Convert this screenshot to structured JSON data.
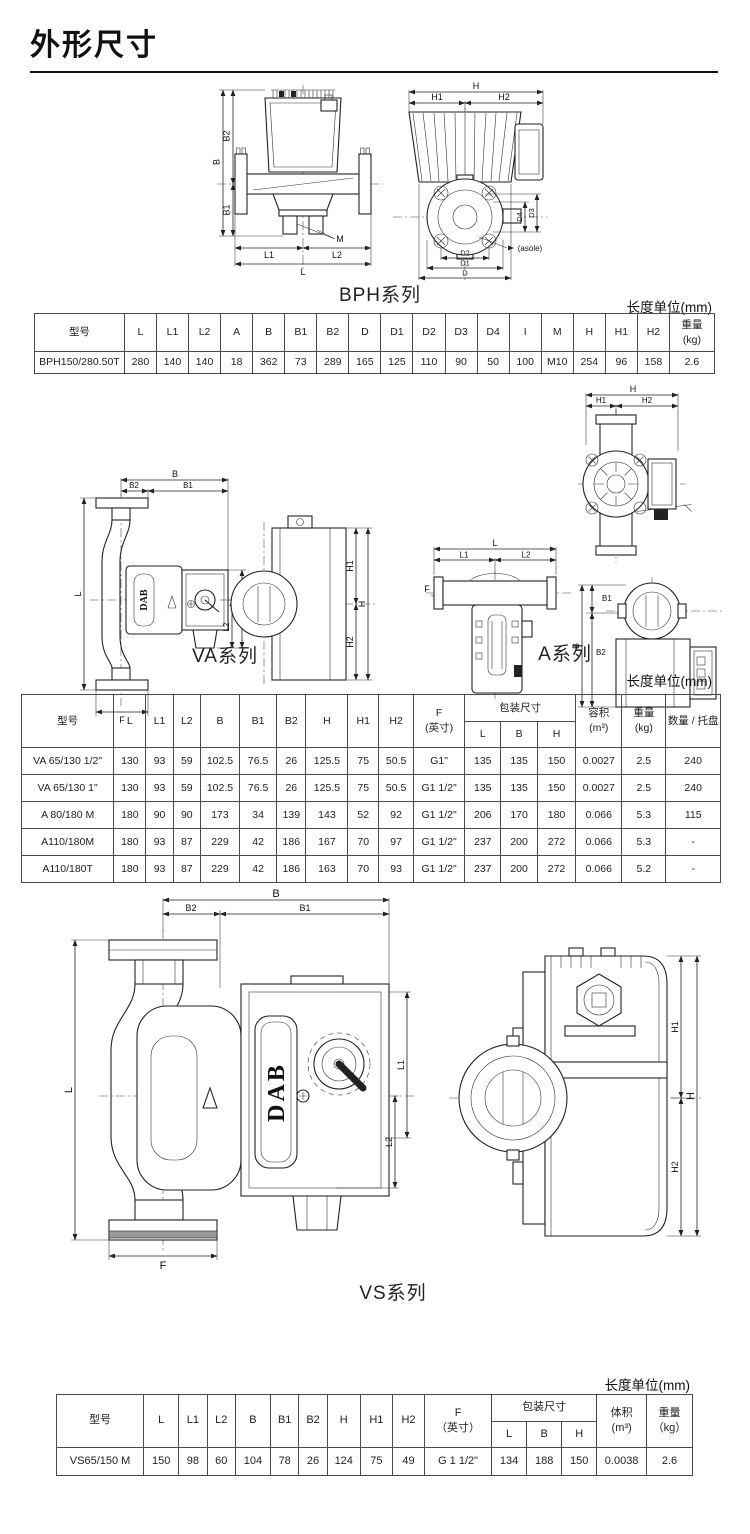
{
  "page": {
    "title": "外形尺寸",
    "unit_note": "长度单位(mm)"
  },
  "brand": "DAB",
  "dims": {
    "L": "L",
    "L1": "L1",
    "L2": "L2",
    "B": "B",
    "B1": "B1",
    "B2": "B2",
    "H": "H",
    "H1": "H1",
    "H2": "H2",
    "D": "D",
    "D1": "D1",
    "D2": "D2",
    "D3": "D3",
    "D4": "D4",
    "M": "M",
    "F": "F",
    "asole": "(asole)"
  },
  "sections": {
    "bph": {
      "caption": "BPH系列"
    },
    "va": {
      "caption": "VA系列"
    },
    "a": {
      "caption": "A系列"
    },
    "vs": {
      "caption": "VS系列"
    }
  },
  "tables": {
    "bph": {
      "headers": [
        "型号",
        "L",
        "L1",
        "L2",
        "A",
        "B",
        "B1",
        "B2",
        "D",
        "D1",
        "D2",
        "D3",
        "D4",
        "I",
        "M",
        "H",
        "H1",
        "H2",
        "重量\n(kg)"
      ],
      "rows": [
        [
          "BPH150/280.50T",
          "280",
          "140",
          "140",
          "18",
          "362",
          "73",
          "289",
          "165",
          "125",
          "110",
          "90",
          "50",
          "100",
          "M10",
          "254",
          "96",
          "158",
          "2.6"
        ]
      ]
    },
    "va_a": {
      "headers": {
        "model": "型号",
        "L": "L",
        "L1": "L1",
        "L2": "L2",
        "B": "B",
        "B1": "B1",
        "B2": "B2",
        "H": "H",
        "H1": "H1",
        "H2": "H2",
        "F": "F\n(英寸)",
        "pack": "包装尺寸",
        "packL": "L",
        "packB": "B",
        "packH": "H",
        "volume": "容积\n(m³)",
        "weight": "重量\n(kg)",
        "qty": "数量 / 托盘"
      },
      "rows": [
        [
          "VA 65/130 1/2\"",
          "130",
          "93",
          "59",
          "102.5",
          "76.5",
          "26",
          "125.5",
          "75",
          "50.5",
          "G1\"",
          "135",
          "135",
          "150",
          "0.0027",
          "2.5",
          "240"
        ],
        [
          "VA 65/130 1\"",
          "130",
          "93",
          "59",
          "102.5",
          "76.5",
          "26",
          "125.5",
          "75",
          "50.5",
          "G1 1/2\"",
          "135",
          "135",
          "150",
          "0.0027",
          "2.5",
          "240"
        ],
        [
          "A 80/180 M",
          "180",
          "90",
          "90",
          "173",
          "34",
          "139",
          "143",
          "52",
          "92",
          "G1 1/2\"",
          "206",
          "170",
          "180",
          "0.066",
          "5.3",
          "115"
        ],
        [
          "A110/180M",
          "180",
          "93",
          "87",
          "229",
          "42",
          "186",
          "167",
          "70",
          "97",
          "G1 1/2\"",
          "237",
          "200",
          "272",
          "0.066",
          "5.3",
          "-"
        ],
        [
          "A110/180T",
          "180",
          "93",
          "87",
          "229",
          "42",
          "186",
          "163",
          "70",
          "93",
          "G1 1/2\"",
          "237",
          "200",
          "272",
          "0.066",
          "5.2",
          "-"
        ]
      ]
    },
    "vs": {
      "headers": {
        "model": "型号",
        "L": "L",
        "L1": "L1",
        "L2": "L2",
        "B": "B",
        "B1": "B1",
        "B2": "B2",
        "H": "H",
        "H1": "H1",
        "H2": "H2",
        "F": "F\n（英寸）",
        "pack": "包装尺寸",
        "packL": "L",
        "packB": "B",
        "packH": "H",
        "volume": "体积\n(m³)",
        "weight": "重量\n（kg）"
      },
      "rows": [
        [
          "VS65/150 M",
          "150",
          "98",
          "60",
          "104",
          "78",
          "26",
          "124",
          "75",
          "49",
          "G 1 1/2\"",
          "134",
          "188",
          "150",
          "0.0038",
          "2.6"
        ]
      ]
    }
  }
}
